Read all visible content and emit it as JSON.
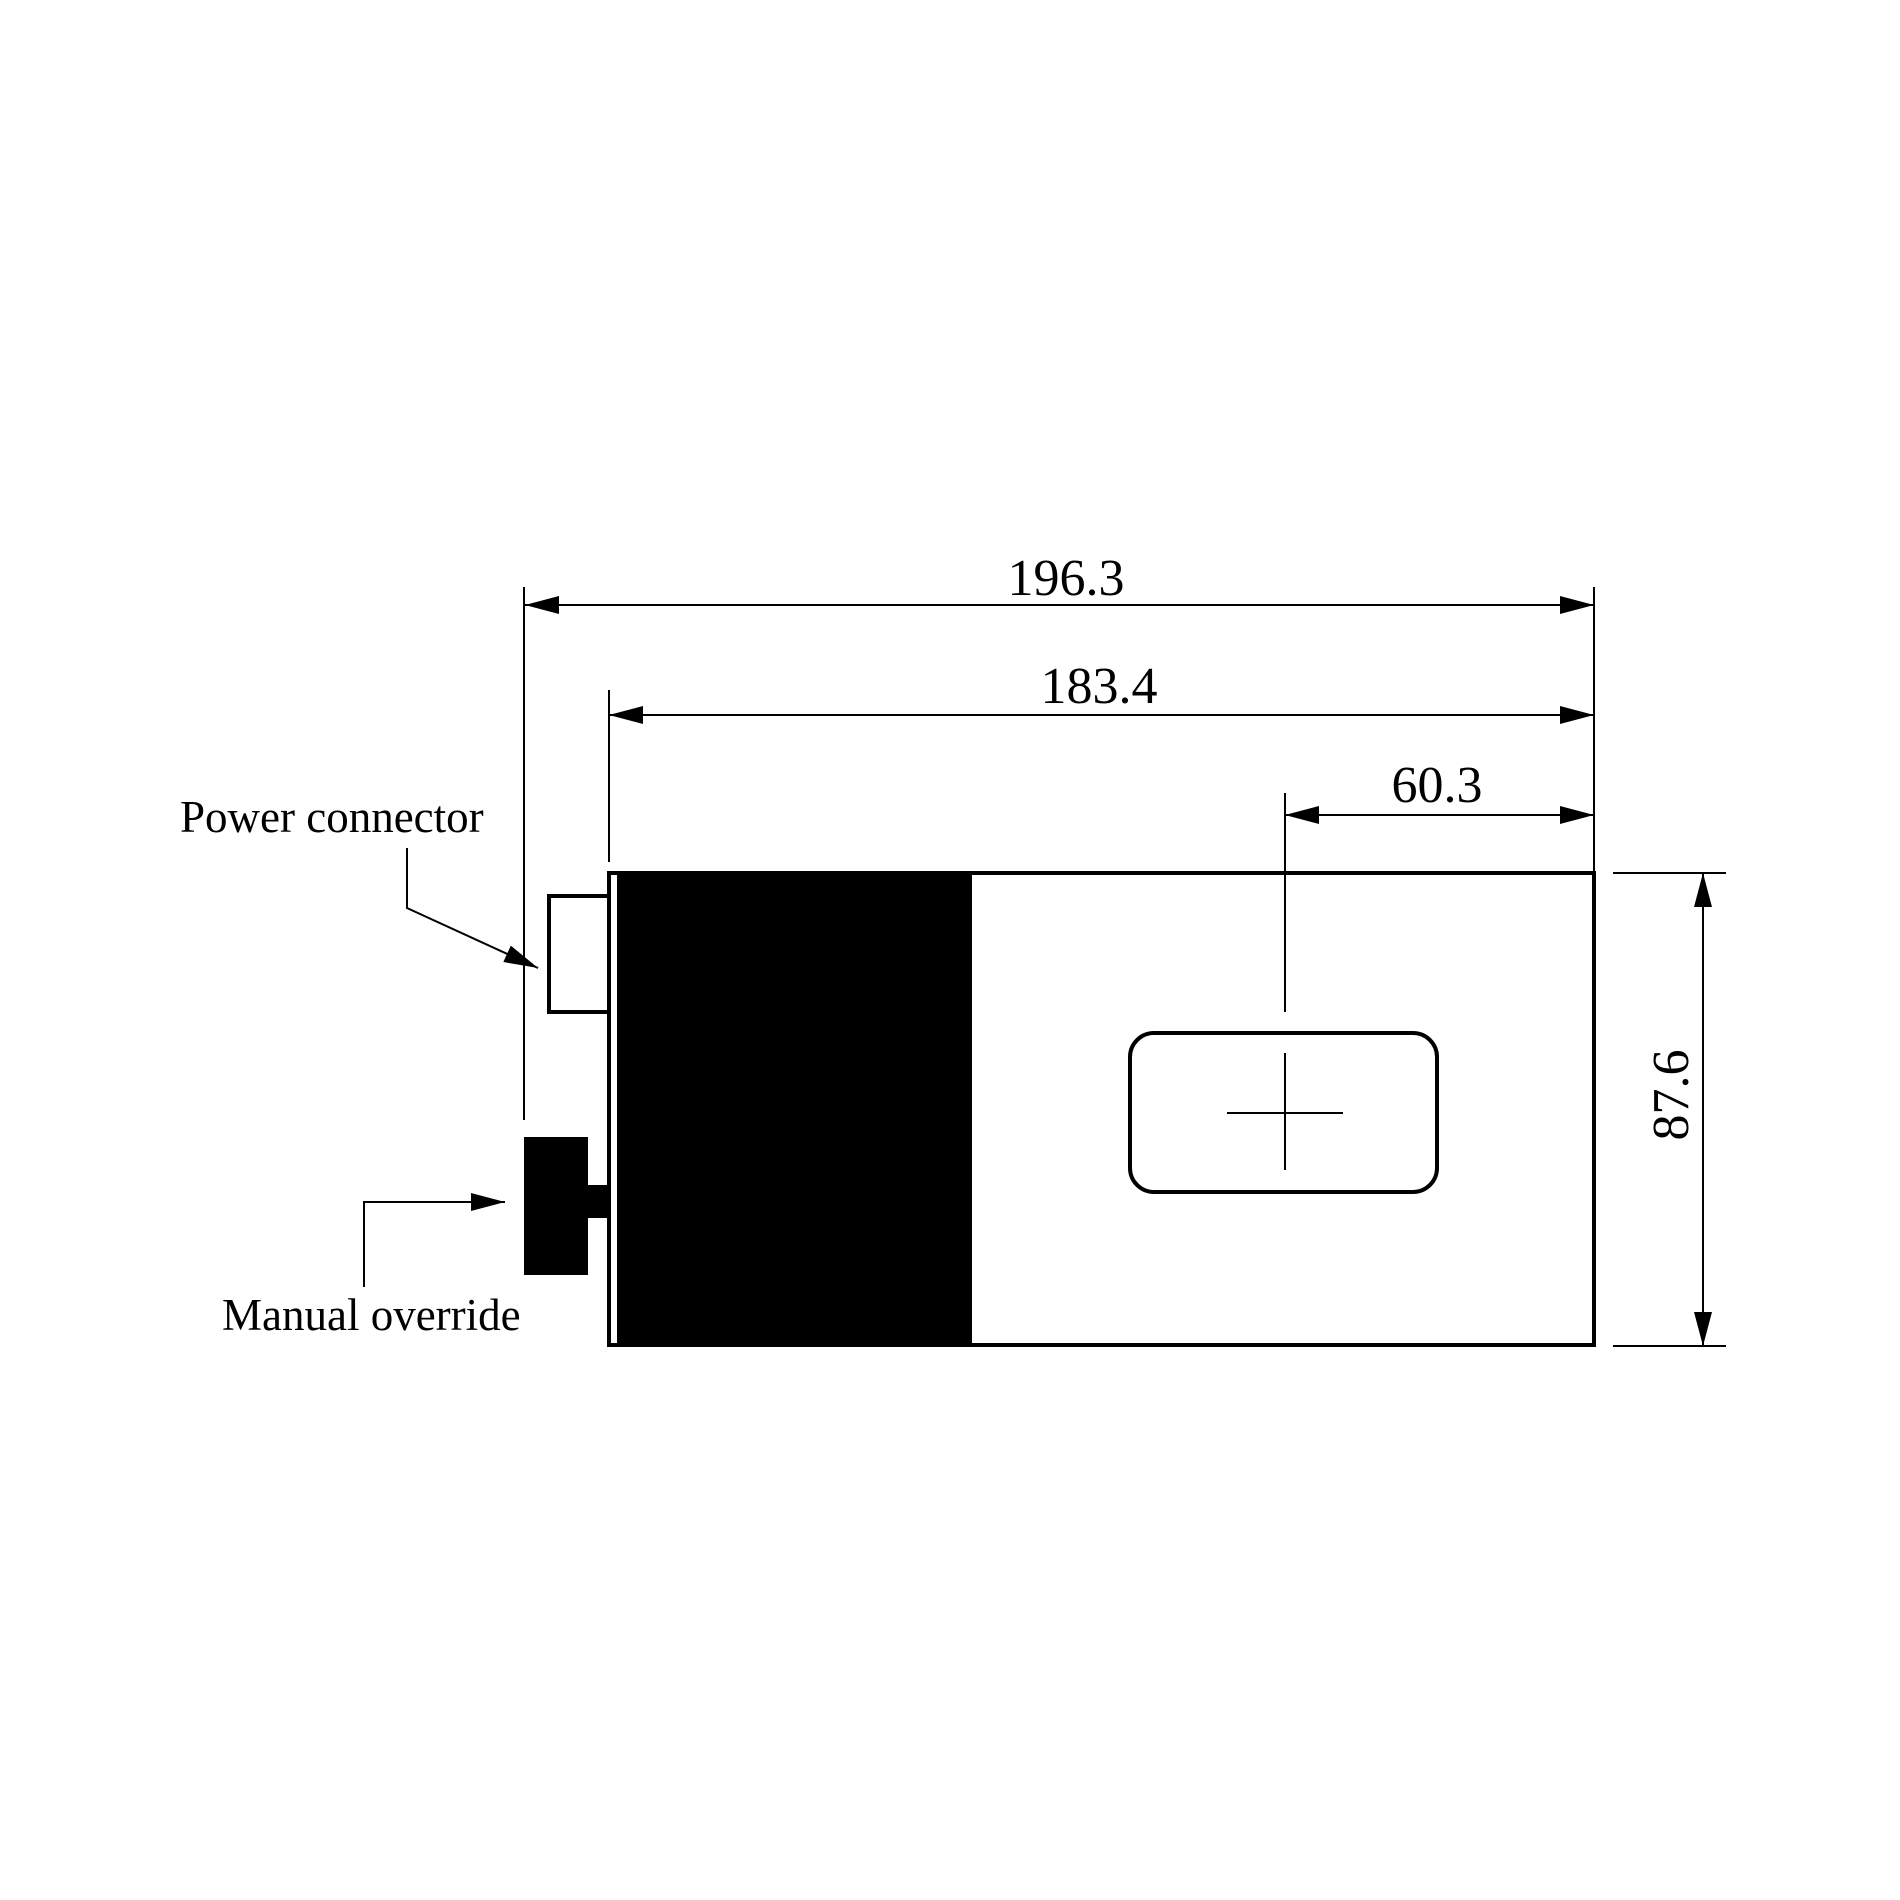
{
  "page": {
    "background": "#ffffff",
    "ink": "#000000",
    "type": "technical-dimension-drawing"
  },
  "labels": {
    "power_connector": "Power connector",
    "manual_override": "Manual override"
  },
  "dimensions": {
    "total_length": "196.3",
    "body_length": "183.4",
    "crosshair_offset": "60.3",
    "body_height": "87.6"
  }
}
